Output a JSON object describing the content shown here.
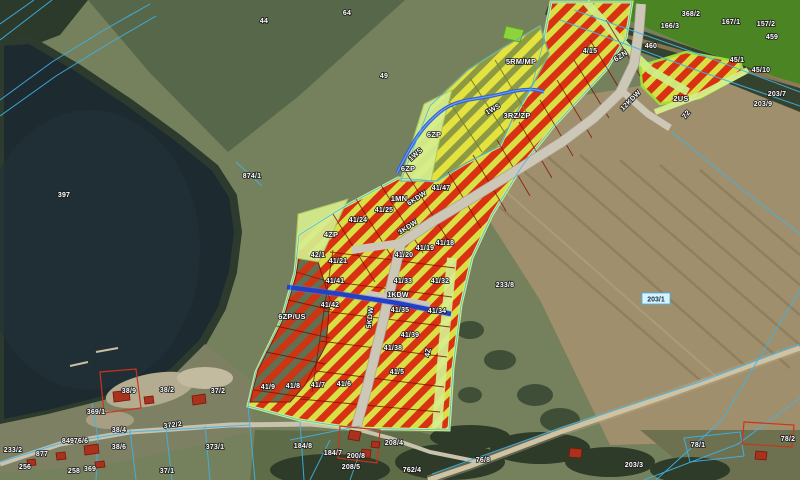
{
  "map": {
    "title": "Cadastral zoning plan overlay on aerial orthophoto",
    "colors": {
      "lake_water": "#1d2b31",
      "field_green": "#57674a",
      "field_olive": "#75805c",
      "field_brown": "#a08f6c",
      "forest": "#2e3d2a",
      "zone_red_stripe": "#d93212",
      "zone_yellow_stripe": "#d8e045",
      "zone_olive_stripe": "#8d9a44",
      "zone_light_green": "#d6ee8e",
      "road_fill": "#cdc7b8",
      "stream_blue": "#2f62d8",
      "cadastral_line": "#3db4ea",
      "building_red": "#a8321e",
      "label_text": "#ffffff"
    },
    "zone_labels": [
      {
        "t": "5RM/MP",
        "x": 521,
        "y": 64,
        "r": 0
      },
      {
        "t": "3RZ/ZP",
        "x": 517,
        "y": 118,
        "r": 0
      },
      {
        "t": "6ZP",
        "x": 434,
        "y": 137,
        "r": 0
      },
      {
        "t": "6ZP",
        "x": 408,
        "y": 171,
        "r": 0
      },
      {
        "t": "6ZN",
        "x": 622,
        "y": 58,
        "r": -33
      },
      {
        "t": "2US",
        "x": 681,
        "y": 101,
        "r": 0
      },
      {
        "t": "4ZP",
        "x": 331,
        "y": 237,
        "r": 0
      },
      {
        "t": "6ZP/US",
        "x": 292,
        "y": 319,
        "r": 0
      },
      {
        "t": "1MN",
        "x": 399,
        "y": 201,
        "r": 0
      },
      {
        "t": "4Z",
        "x": 430,
        "y": 353,
        "r": -80
      },
      {
        "t": "72",
        "x": 688,
        "y": 116,
        "r": -50
      }
    ],
    "road_labels": [
      {
        "t": "6KDW",
        "x": 418,
        "y": 200,
        "r": -33
      },
      {
        "t": "3KDW",
        "x": 409,
        "y": 229,
        "r": -33
      },
      {
        "t": "1KDW",
        "x": 398,
        "y": 297,
        "r": 0
      },
      {
        "t": "5KDW",
        "x": 372,
        "y": 318,
        "r": -83
      },
      {
        "t": "12KDW",
        "x": 632,
        "y": 102,
        "r": -45
      }
    ],
    "water_labels": [
      {
        "t": "1WS",
        "x": 494,
        "y": 111,
        "r": -30
      },
      {
        "t": "1WS",
        "x": 417,
        "y": 156,
        "r": -42
      }
    ],
    "parcel_labels": [
      {
        "t": "44",
        "x": 264,
        "y": 23
      },
      {
        "t": "64",
        "x": 347,
        "y": 15
      },
      {
        "t": "49",
        "x": 384,
        "y": 78
      },
      {
        "t": "397",
        "x": 64,
        "y": 197
      },
      {
        "t": "874/1",
        "x": 252,
        "y": 178
      },
      {
        "t": "368/2",
        "x": 691,
        "y": 16
      },
      {
        "t": "166/3",
        "x": 670,
        "y": 28
      },
      {
        "t": "167/1",
        "x": 731,
        "y": 24
      },
      {
        "t": "157/2",
        "x": 766,
        "y": 26
      },
      {
        "t": "459",
        "x": 772,
        "y": 39
      },
      {
        "t": "460",
        "x": 651,
        "y": 48
      },
      {
        "t": "45/1",
        "x": 737,
        "y": 62
      },
      {
        "t": "45/10",
        "x": 761,
        "y": 72
      },
      {
        "t": "203/7",
        "x": 777,
        "y": 96
      },
      {
        "t": "203/9",
        "x": 763,
        "y": 106
      },
      {
        "t": "4/15",
        "x": 590,
        "y": 53
      },
      {
        "t": "233/8",
        "x": 505,
        "y": 287
      },
      {
        "t": "41/47",
        "x": 441,
        "y": 190
      },
      {
        "t": "41/24",
        "x": 358,
        "y": 222
      },
      {
        "t": "41/25",
        "x": 384,
        "y": 212
      },
      {
        "t": "42/1",
        "x": 318,
        "y": 257
      },
      {
        "t": "41/21",
        "x": 338,
        "y": 263
      },
      {
        "t": "41/20",
        "x": 404,
        "y": 257
      },
      {
        "t": "41/19",
        "x": 425,
        "y": 250
      },
      {
        "t": "41/18",
        "x": 445,
        "y": 245
      },
      {
        "t": "41/41",
        "x": 335,
        "y": 283
      },
      {
        "t": "41/33",
        "x": 403,
        "y": 283
      },
      {
        "t": "41/32",
        "x": 440,
        "y": 283
      },
      {
        "t": "41/42",
        "x": 330,
        "y": 307
      },
      {
        "t": "41/35",
        "x": 400,
        "y": 312
      },
      {
        "t": "41/34",
        "x": 437,
        "y": 313
      },
      {
        "t": "41/39",
        "x": 410,
        "y": 337
      },
      {
        "t": "41/38",
        "x": 393,
        "y": 350
      },
      {
        "t": "41/9",
        "x": 268,
        "y": 389
      },
      {
        "t": "41/8",
        "x": 293,
        "y": 388
      },
      {
        "t": "41/7",
        "x": 318,
        "y": 387
      },
      {
        "t": "41/6",
        "x": 344,
        "y": 386
      },
      {
        "t": "41/5",
        "x": 397,
        "y": 374
      },
      {
        "t": "369/1",
        "x": 96,
        "y": 414
      },
      {
        "t": "38/9",
        "x": 129,
        "y": 393
      },
      {
        "t": "38/2",
        "x": 167,
        "y": 392
      },
      {
        "t": "37/2",
        "x": 218,
        "y": 393
      },
      {
        "t": "38/4",
        "x": 119,
        "y": 432
      },
      {
        "t": "38/6",
        "x": 119,
        "y": 449
      },
      {
        "t": "372/2",
        "x": 173,
        "y": 427,
        "r": -7
      },
      {
        "t": "373/1",
        "x": 215,
        "y": 449
      },
      {
        "t": "37/1",
        "x": 167,
        "y": 473
      },
      {
        "t": "233/2",
        "x": 13,
        "y": 452
      },
      {
        "t": "877",
        "x": 42,
        "y": 456
      },
      {
        "t": "849",
        "x": 68,
        "y": 443
      },
      {
        "t": "76/6",
        "x": 81,
        "y": 443
      },
      {
        "t": "256",
        "x": 25,
        "y": 469
      },
      {
        "t": "258",
        "x": 74,
        "y": 473
      },
      {
        "t": "369",
        "x": 90,
        "y": 471
      },
      {
        "t": "184/8",
        "x": 303,
        "y": 448
      },
      {
        "t": "184/7",
        "x": 333,
        "y": 455
      },
      {
        "t": "200/8",
        "x": 356,
        "y": 458
      },
      {
        "t": "208/5",
        "x": 351,
        "y": 469
      },
      {
        "t": "208/4",
        "x": 394,
        "y": 445
      },
      {
        "t": "762/4",
        "x": 412,
        "y": 472
      },
      {
        "t": "76/8",
        "x": 483,
        "y": 462
      },
      {
        "t": "203/3",
        "x": 634,
        "y": 467
      },
      {
        "t": "78/1",
        "x": 698,
        "y": 447
      },
      {
        "t": "78/2",
        "x": 788,
        "y": 441
      }
    ],
    "selected_label": {
      "t": "203/1",
      "x": 656,
      "y": 299
    }
  }
}
